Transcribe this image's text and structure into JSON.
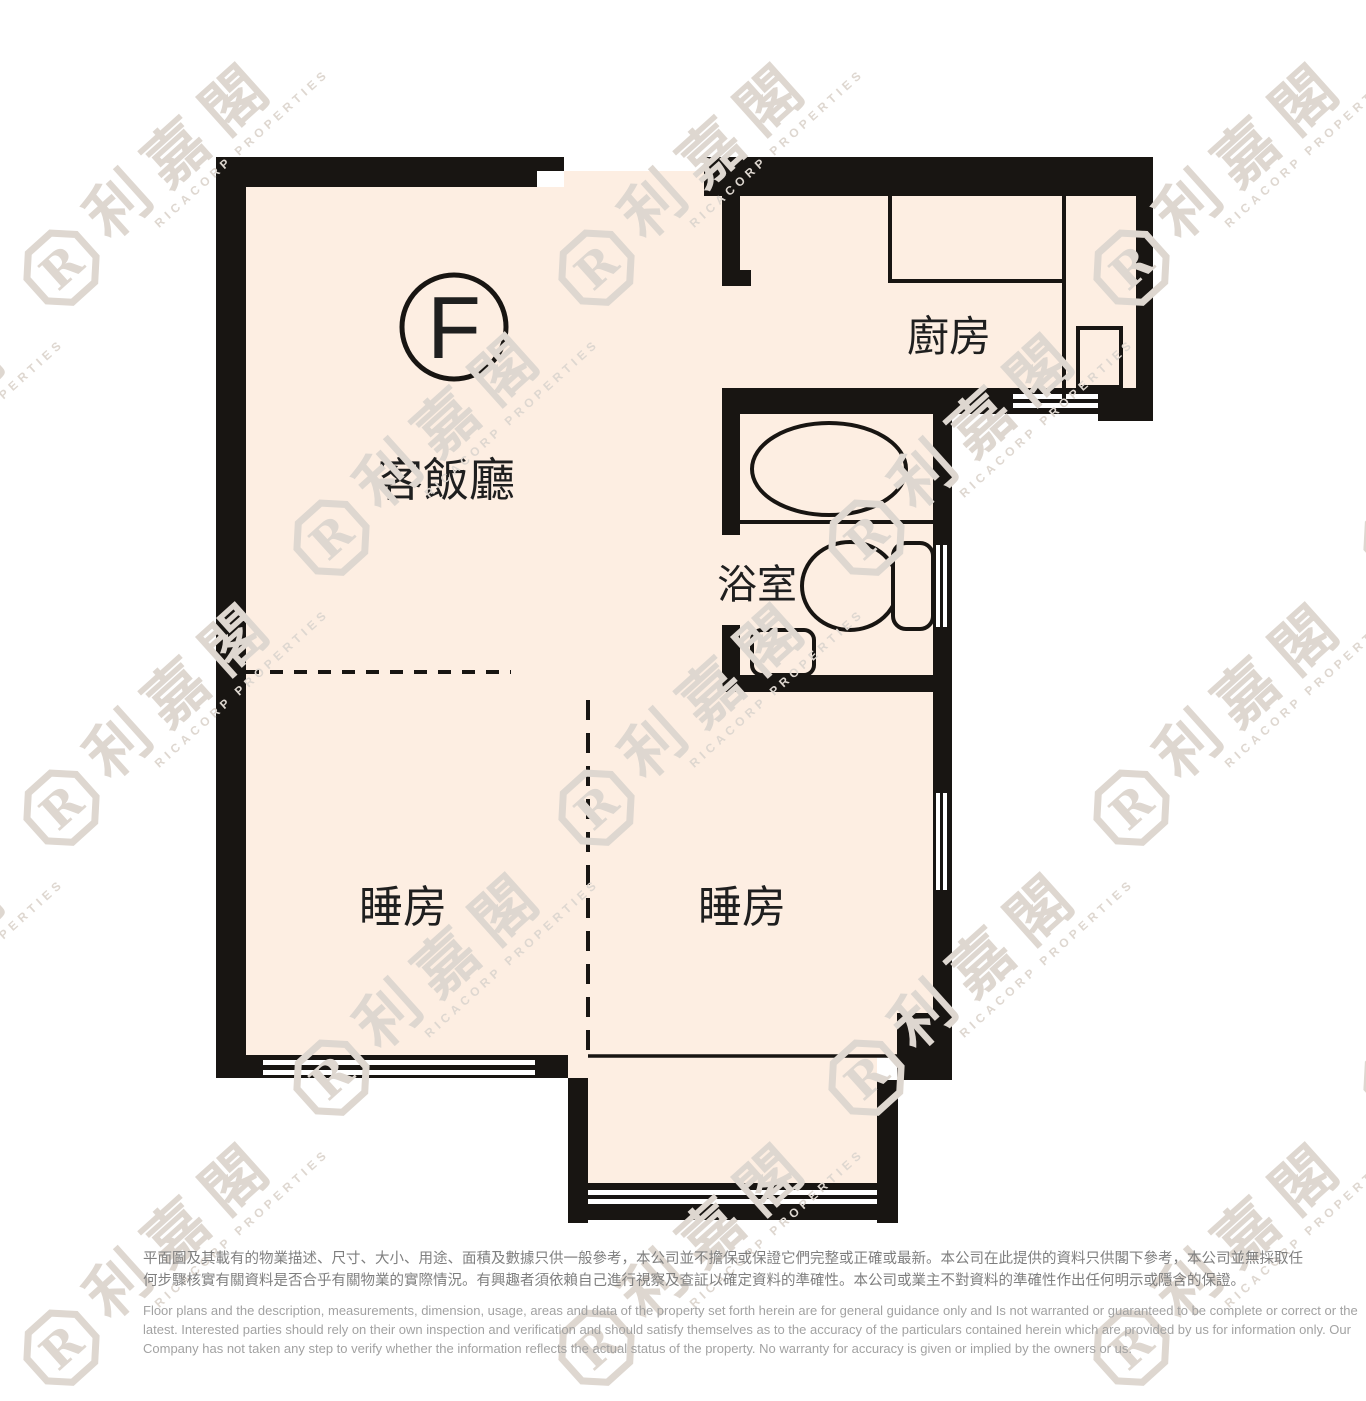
{
  "floor_plan": {
    "unit_marker": "F",
    "rooms": {
      "living_dining": "客飯廳",
      "kitchen": "廚房",
      "bathroom": "浴室",
      "bedroom_1": "睡房",
      "bedroom_2": "睡房"
    },
    "colors": {
      "floor": "#fdeee2",
      "wall": "#181512",
      "label": "#1f1f1f",
      "watermark": "#ded7d0"
    }
  },
  "watermark": {
    "cjk": "利嘉閣",
    "latin": "RICACORP PROPERTIES",
    "logo_letter": "R"
  },
  "disclaimer": {
    "zh_line1": "平面圖及其載有的物業描述、尺寸、大小、用途、面積及數據只供一般參考，本公司並不擔保或保證它們完整或正確或最新。本公司在此提供的資料只供閣下參考，本公司並無採取任",
    "zh_line2": "何步驟核實有關資料是否合乎有關物業的實際情況。有興趣者須依賴自己進行視察及查証以確定資料的準確性。本公司或業主不對資料的準確性作出任何明示或隱含的保證。",
    "en_line1": "Floor plans and the description, measurements, dimension, usage, areas and data of the property set forth herein are for general guidance only and Is not warranted or guaranteed to be complete or correct or the",
    "en_line2": "latest. Interested parties should rely on their own inspection and verification and should satisfy themselves as to the accuracy of the particulars contained herein which are provided by us for information only.  Our",
    "en_line3": "Company has not taken any step to verify whether the information reflects the actual status of the property.  No warranty for accuracy is given or implied by the owners or us."
  }
}
